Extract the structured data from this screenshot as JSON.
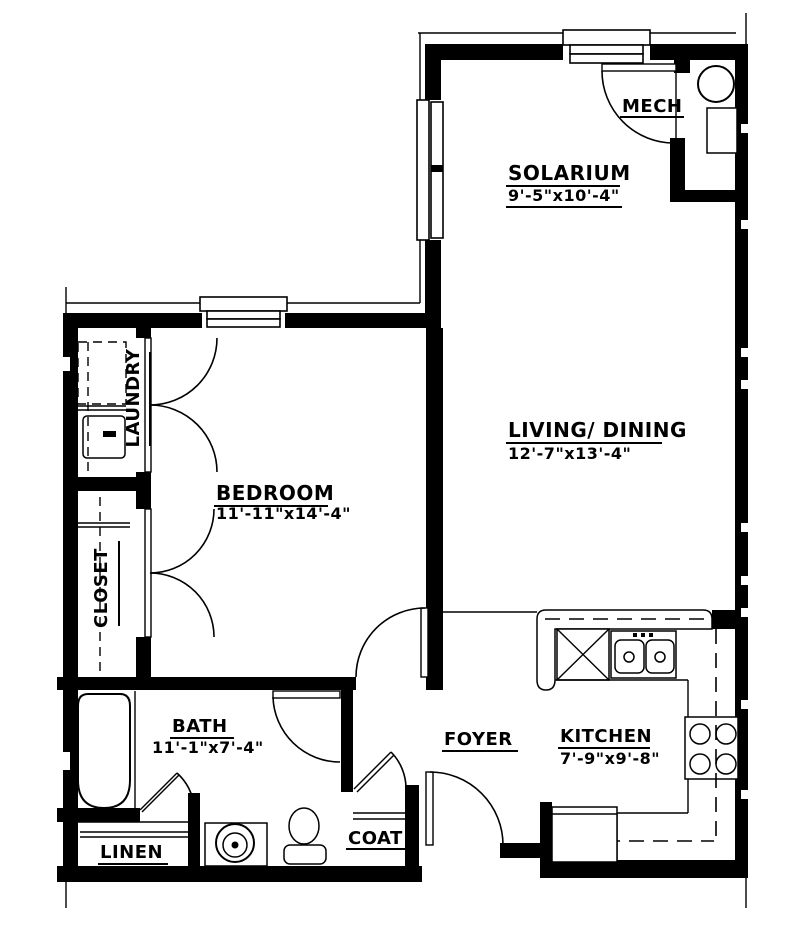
{
  "drawing_title": "One-bedroom apartment floor plan",
  "colors": {
    "wall": "#000000",
    "background": "#ffffff"
  },
  "rooms": {
    "solarium": {
      "name": "SOLARIUM",
      "dims": "9'-5\"x10'-4\""
    },
    "mech": {
      "name": "MECH"
    },
    "living": {
      "name": "LIVING/ DINING",
      "dims": "12'-7\"x13'-4\""
    },
    "bedroom": {
      "name": "BEDROOM",
      "dims": "11'-11\"x14'-4\""
    },
    "laundry": {
      "name": "LAUNDRY"
    },
    "closet": {
      "name": "CLOSET"
    },
    "bath": {
      "name": "BATH",
      "dims": "11'-1\"x7'-4\""
    },
    "foyer": {
      "name": "FOYER"
    },
    "kitchen": {
      "name": "KITCHEN",
      "dims": "7'-9\"x9'-8\""
    },
    "linen": {
      "name": "LINEN"
    },
    "coat": {
      "name": "COAT"
    }
  }
}
